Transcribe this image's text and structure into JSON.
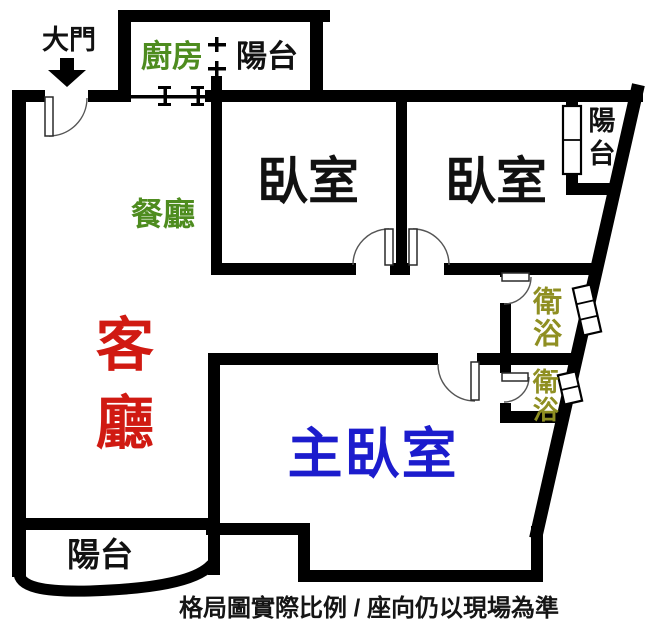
{
  "labels": {
    "entrance": "大門",
    "kitchen": "廚房",
    "balcony_top": "陽台",
    "bedroom1": "臥室",
    "bedroom2": "臥室",
    "balcony_right": "陽台",
    "dining": "餐廳",
    "living": "客廳",
    "bath1": "衛浴",
    "bath2": "衛浴",
    "master": "主臥室",
    "balcony_bottom": "陽台",
    "caption": "格局圖實際比例 / 座向仍以現場為準"
  },
  "colors": {
    "wall": "#000000",
    "kitchen_dining": "#4e8c1f",
    "bath": "#8f8f22",
    "living": "#d01a12",
    "master": "#1c1ccd",
    "text": "#111111"
  }
}
